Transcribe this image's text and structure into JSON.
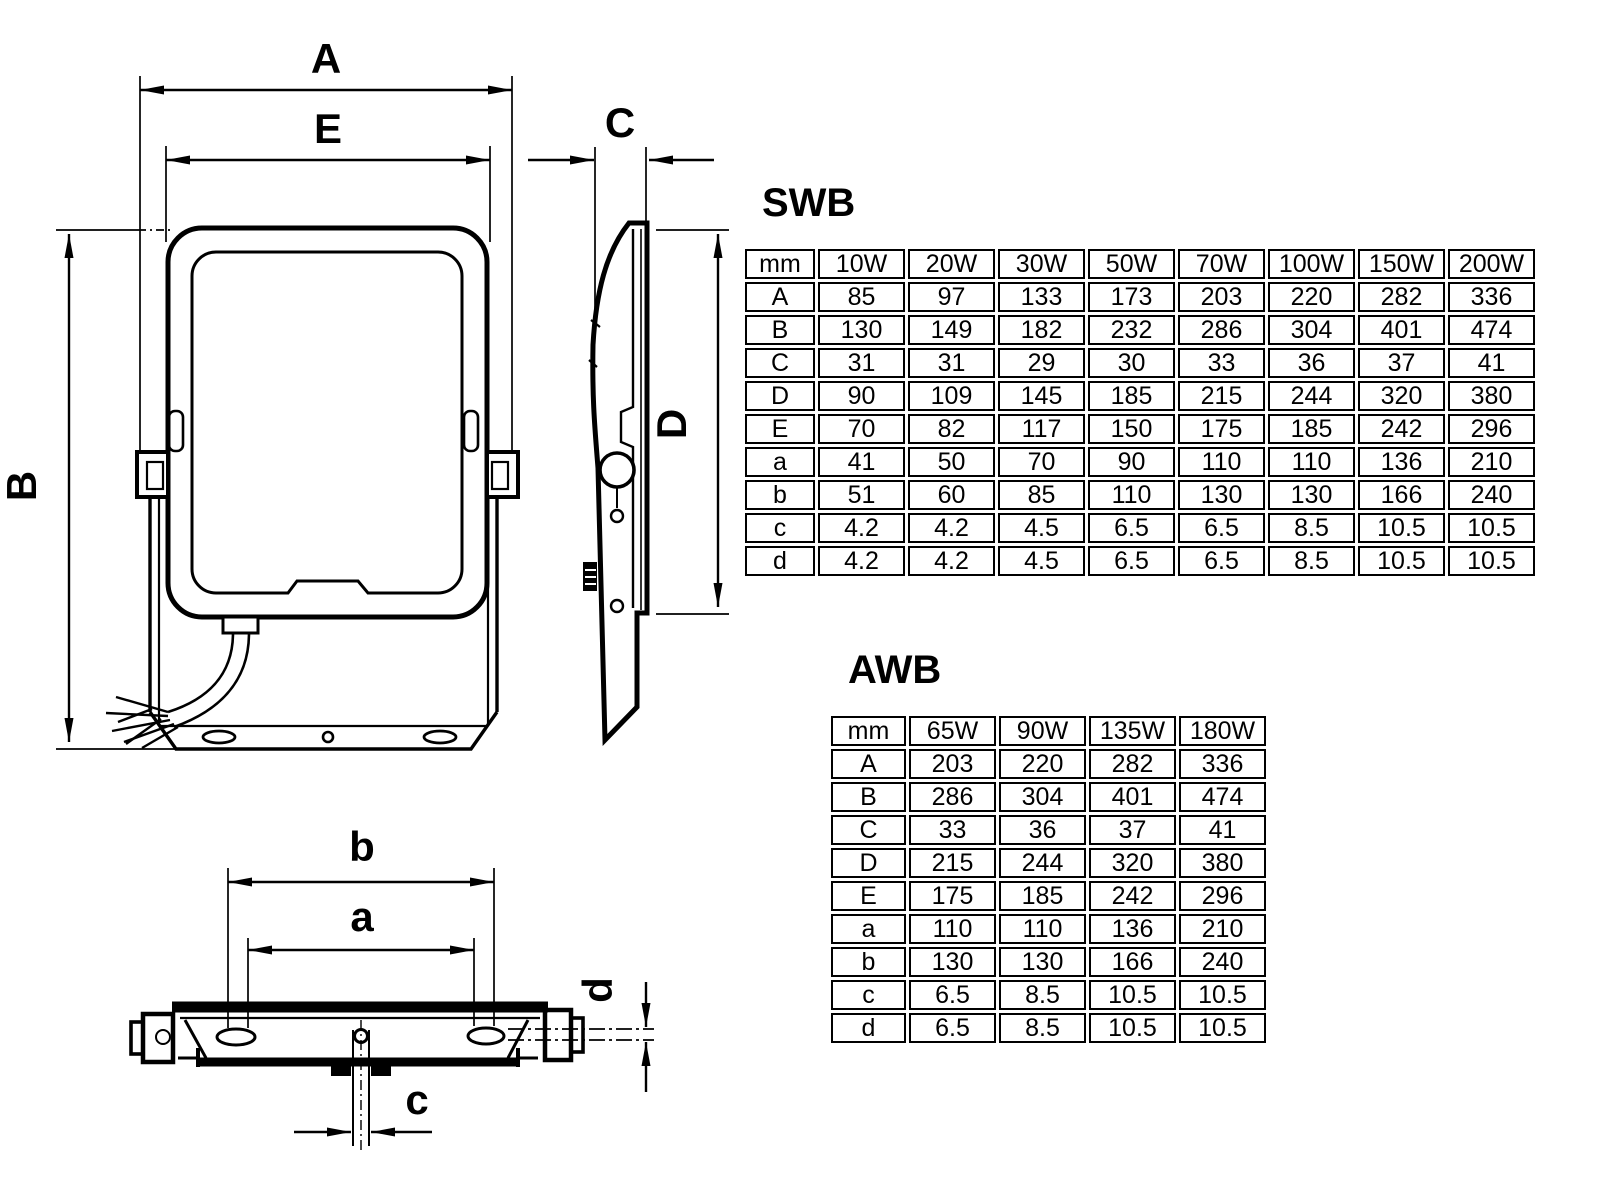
{
  "page": {
    "background": "#ffffff",
    "line_color": "#000000"
  },
  "drawing": {
    "front_view": {
      "width_label": "A",
      "lens_width_label": "E",
      "height_label": "B"
    },
    "side_view": {
      "depth_label": "C",
      "bracket_height_label": "D"
    },
    "bottom_view": {
      "outer_slot_spacing_label": "b",
      "inner_slot_spacing_label": "a",
      "center_hole_label": "c",
      "slot_width_label": "d"
    }
  },
  "tables": [
    {
      "title": "SWB",
      "corner": "mm",
      "columns": [
        "10W",
        "20W",
        "30W",
        "50W",
        "70W",
        "100W",
        "150W",
        "200W"
      ],
      "rows": [
        {
          "label": "A",
          "values": [
            "85",
            "97",
            "133",
            "173",
            "203",
            "220",
            "282",
            "336"
          ]
        },
        {
          "label": "B",
          "values": [
            "130",
            "149",
            "182",
            "232",
            "286",
            "304",
            "401",
            "474"
          ]
        },
        {
          "label": "C",
          "values": [
            "31",
            "31",
            "29",
            "30",
            "33",
            "36",
            "37",
            "41"
          ]
        },
        {
          "label": "D",
          "values": [
            "90",
            "109",
            "145",
            "185",
            "215",
            "244",
            "320",
            "380"
          ]
        },
        {
          "label": "E",
          "values": [
            "70",
            "82",
            "117",
            "150",
            "175",
            "185",
            "242",
            "296"
          ]
        },
        {
          "label": "a",
          "values": [
            "41",
            "50",
            "70",
            "90",
            "110",
            "110",
            "136",
            "210"
          ]
        },
        {
          "label": "b",
          "values": [
            "51",
            "60",
            "85",
            "110",
            "130",
            "130",
            "166",
            "240"
          ]
        },
        {
          "label": "c",
          "values": [
            "4.2",
            "4.2",
            "4.5",
            "6.5",
            "6.5",
            "8.5",
            "10.5",
            "10.5"
          ]
        },
        {
          "label": "d",
          "values": [
            "4.2",
            "4.2",
            "4.5",
            "6.5",
            "6.5",
            "8.5",
            "10.5",
            "10.5"
          ]
        }
      ]
    },
    {
      "title": "AWB",
      "corner": "mm",
      "columns": [
        "65W",
        "90W",
        "135W",
        "180W"
      ],
      "rows": [
        {
          "label": "A",
          "values": [
            "203",
            "220",
            "282",
            "336"
          ]
        },
        {
          "label": "B",
          "values": [
            "286",
            "304",
            "401",
            "474"
          ]
        },
        {
          "label": "C",
          "values": [
            "33",
            "36",
            "37",
            "41"
          ]
        },
        {
          "label": "D",
          "values": [
            "215",
            "244",
            "320",
            "380"
          ]
        },
        {
          "label": "E",
          "values": [
            "175",
            "185",
            "242",
            "296"
          ]
        },
        {
          "label": "a",
          "values": [
            "110",
            "110",
            "136",
            "210"
          ]
        },
        {
          "label": "b",
          "values": [
            "130",
            "130",
            "166",
            "240"
          ]
        },
        {
          "label": "c",
          "values": [
            "6.5",
            "8.5",
            "10.5",
            "10.5"
          ]
        },
        {
          "label": "d",
          "values": [
            "6.5",
            "8.5",
            "10.5",
            "10.5"
          ]
        }
      ]
    }
  ]
}
